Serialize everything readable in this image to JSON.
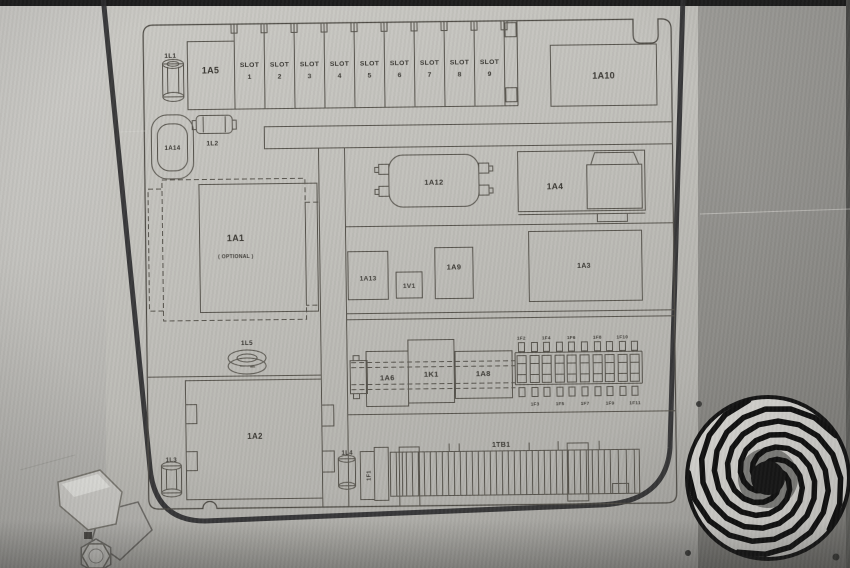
{
  "diagram": {
    "slot_word": "SLOT",
    "slot_numbers": [
      "1",
      "2",
      "3",
      "4",
      "5",
      "6",
      "7",
      "8",
      "9"
    ],
    "labels": {
      "l1": "1L1",
      "a5": "1A5",
      "a10": "1A10",
      "a14": "1A14",
      "l2": "1L2",
      "a12": "1A12",
      "a4": "1A4",
      "a1": "1A1",
      "a1_note": "( OPTIONAL )",
      "a13": "1A13",
      "v1": "1V1",
      "a9": "1A9",
      "a3": "1A3",
      "l5": "1L5",
      "a6": "1A6",
      "k1": "1K1",
      "a8": "1A8",
      "a2": "1A2",
      "l3": "1L3",
      "l4": "1L4",
      "f1": "1F1",
      "tb1": "1TB1"
    },
    "fuses_top": [
      "1F2",
      "1F4",
      "1F6",
      "1F8",
      "1F10"
    ],
    "fuses_bottom": [
      "1F3",
      "1F5",
      "1F7",
      "1F9",
      "1F11"
    ]
  },
  "colors": {
    "plate": "#c0bfba",
    "plate_light": "#cac9c4",
    "right_panel": "#8f8e8a",
    "diagram_line": "#57544d",
    "diagram_text": "#3a3833",
    "door_gap": "#2d2d2f",
    "fan_guard": "#101010",
    "fan_disc": "#d7d6d2",
    "top_edge": "#1c1c1c"
  }
}
